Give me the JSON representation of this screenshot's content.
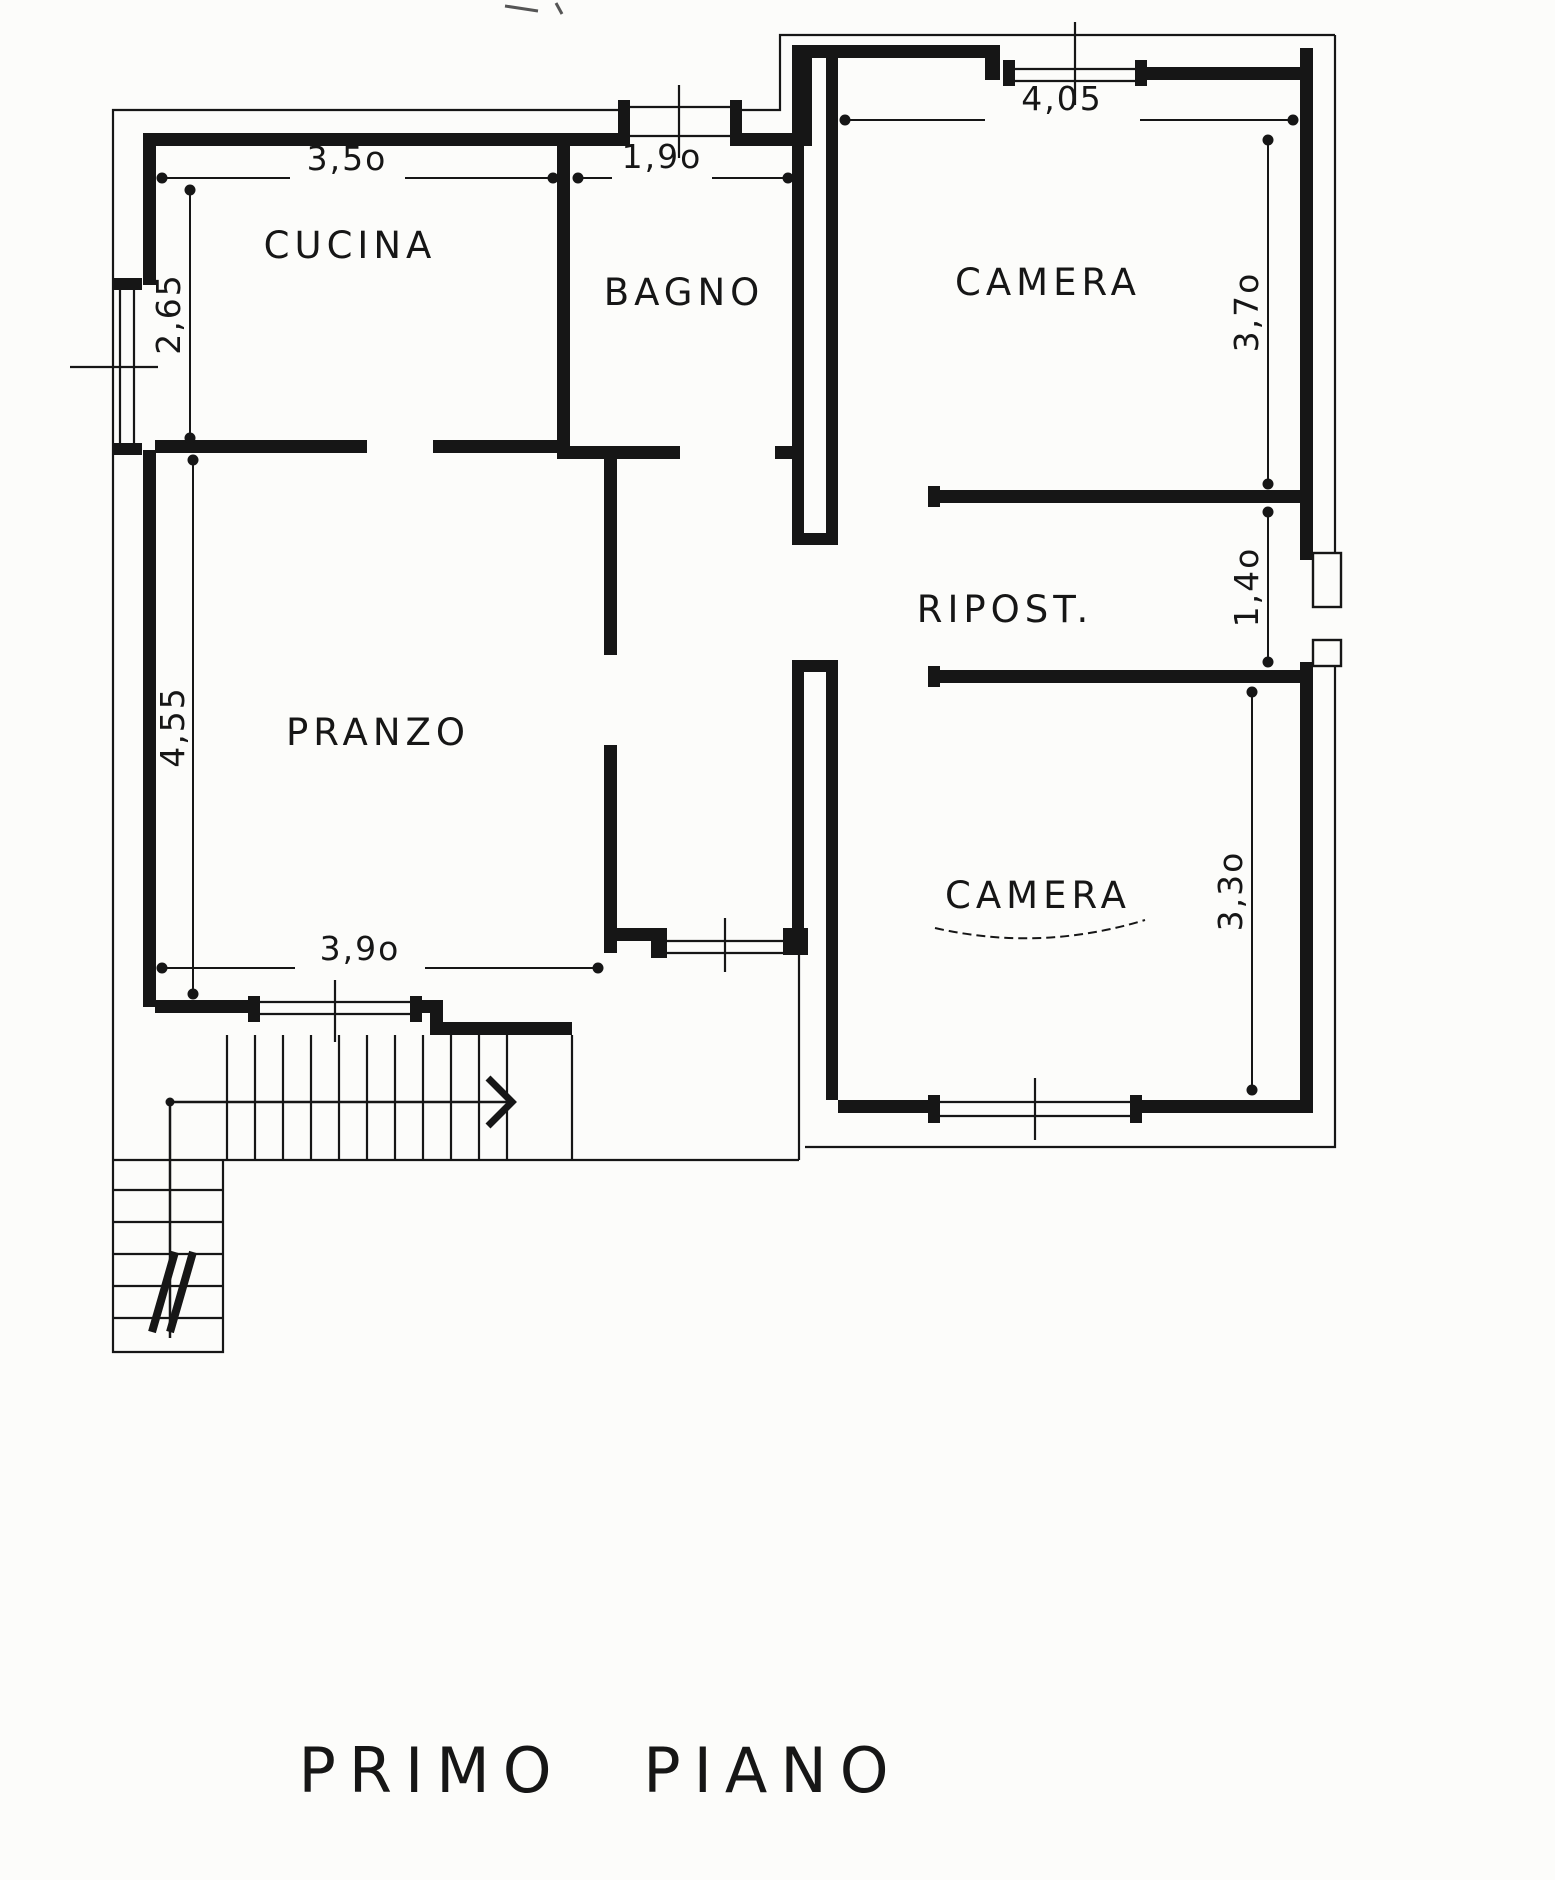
{
  "page_title": "PRIMO PIANO",
  "rooms": {
    "cucina": {
      "label": "CUCINA",
      "width": "3,5o",
      "height": "2,65"
    },
    "bagno": {
      "label": "BAGNO",
      "width": "1,9o"
    },
    "camera_top": {
      "label": "CAMERA",
      "width": "4,05",
      "height": "3,7o"
    },
    "pranzo": {
      "label": "PRANZO",
      "height": "4,55",
      "width_bottom": "3,9o"
    },
    "ripost": {
      "label": "RIPOST.",
      "height": "1,4o"
    },
    "camera_bottom": {
      "label": "CAMERA",
      "height": "3,3o"
    }
  },
  "colors": {
    "ink": "#161616",
    "paper": "#fcfcfa"
  }
}
